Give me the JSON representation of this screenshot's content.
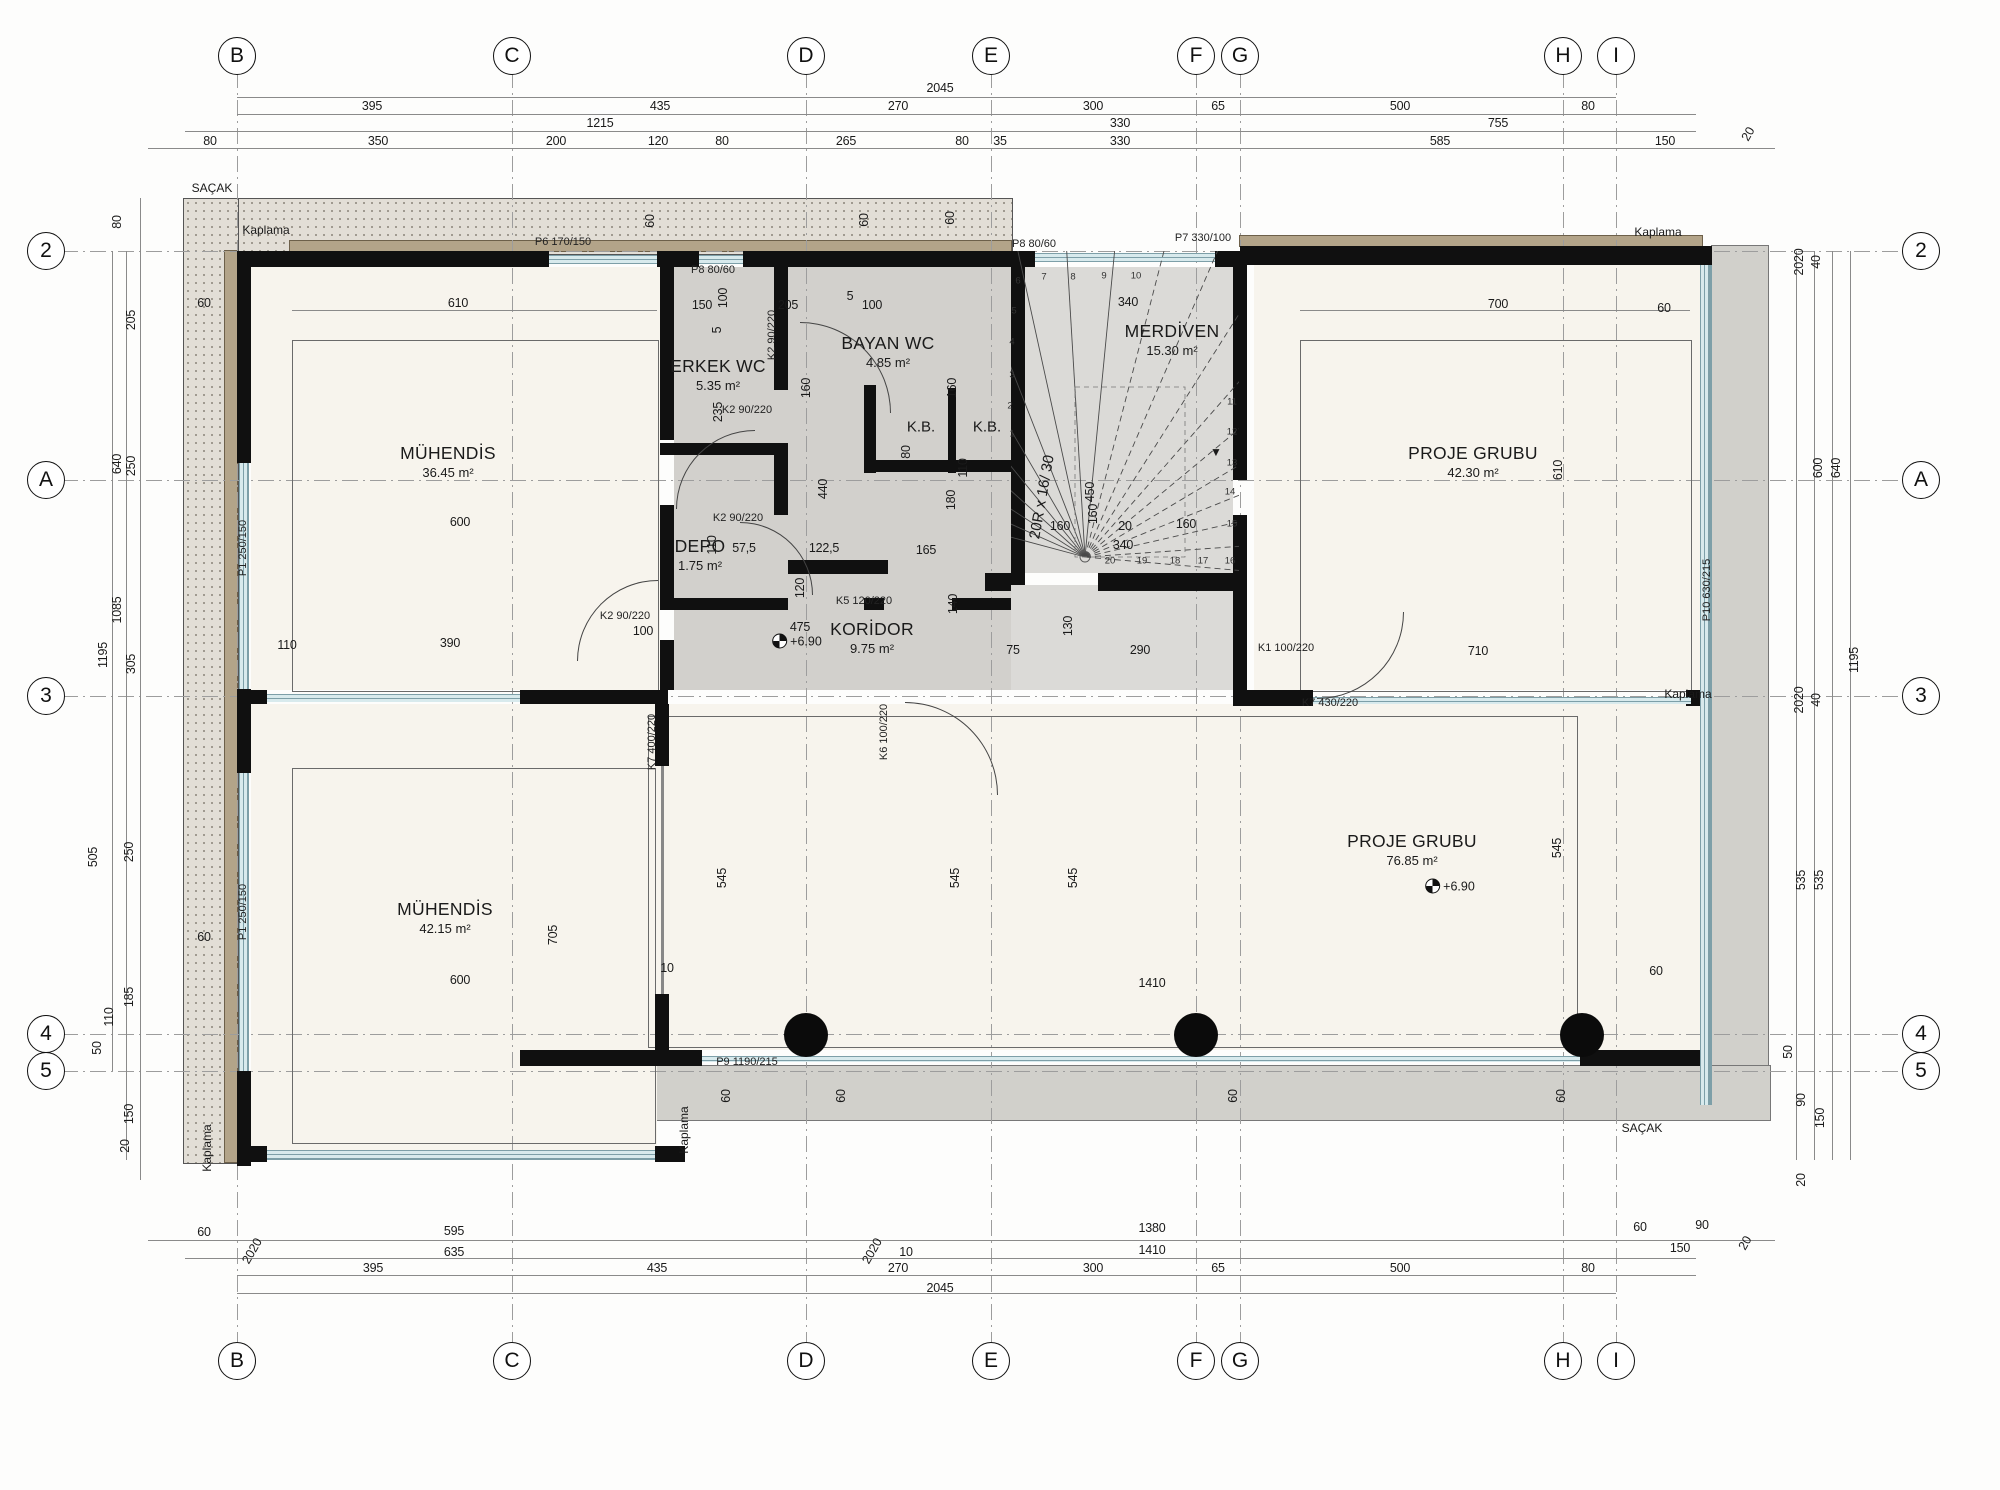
{
  "colors": {
    "wall": "#101010",
    "eave_fill": "#e2ded6",
    "eave_dot": "#9a948a",
    "kaplama_tan": "#b3a489",
    "service_floor": "#d2d0cc",
    "stair_floor": "#dbdad7",
    "room_floor": "#f7f4ed",
    "glazing": "#d8eaed",
    "glazing_frame": "#7d9fa8",
    "balcony": "#d1d0cb",
    "accent_ink": "#1a1a1a"
  },
  "grid": {
    "cols": [
      {
        "label": "B",
        "x": 237
      },
      {
        "label": "C",
        "x": 512
      },
      {
        "label": "D",
        "x": 806
      },
      {
        "label": "E",
        "x": 991
      },
      {
        "label": "F",
        "x": 1196
      },
      {
        "label": "G",
        "x": 1240
      },
      {
        "label": "H",
        "x": 1563
      },
      {
        "label": "I",
        "x": 1616
      }
    ],
    "rows": [
      {
        "label": "2",
        "y": 251
      },
      {
        "label": "A",
        "y": 480
      },
      {
        "label": "3",
        "y": 696
      },
      {
        "label": "4",
        "y": 1034
      },
      {
        "label": "5",
        "y": 1071
      }
    ]
  },
  "rooms": [
    {
      "name": "MÜHENDİS",
      "area": "36.45 m²",
      "x": 448,
      "y": 462
    },
    {
      "name": "ERKEK WC",
      "area": "5.35 m²",
      "x": 718,
      "y": 375
    },
    {
      "name": "BAYAN WC",
      "area": "4.85 m²",
      "x": 888,
      "y": 352
    },
    {
      "name": "DEPO",
      "area": "1.75 m²",
      "x": 700,
      "y": 555
    },
    {
      "name": "KORİDOR",
      "area": "9.75 m²",
      "x": 872,
      "y": 638
    },
    {
      "name": "MERDİVEN",
      "area": "15.30 m²",
      "x": 1172,
      "y": 340
    },
    {
      "name": "PROJE GRUBU",
      "area": "42.30 m²",
      "x": 1473,
      "y": 462
    },
    {
      "name": "MÜHENDİS",
      "area": "42.15 m²",
      "x": 445,
      "y": 918
    },
    {
      "name": "PROJE GRUBU",
      "area": "76.85 m²",
      "x": 1412,
      "y": 850
    }
  ],
  "kb": [
    {
      "label": "K.B.",
      "x": 921,
      "y": 427
    },
    {
      "label": "K.B.",
      "x": 987,
      "y": 427
    }
  ],
  "levels": [
    {
      "text": "+6.90",
      "x": 797,
      "y": 641
    },
    {
      "text": "+6.90",
      "x": 1450,
      "y": 886
    }
  ],
  "openings": [
    {
      "label": "P6 170/150",
      "x": 563,
      "y": 242
    },
    {
      "label": "P8 80/60",
      "x": 713,
      "y": 270
    },
    {
      "label": "P8 80/60",
      "x": 1034,
      "y": 244
    },
    {
      "label": "P7 330/100",
      "x": 1203,
      "y": 238
    },
    {
      "label": "P1 250/150",
      "x": 243,
      "y": 548,
      "r": -90
    },
    {
      "label": "P1 250/150",
      "x": 243,
      "y": 912,
      "r": -90
    },
    {
      "label": "K2 90/220",
      "x": 747,
      "y": 410
    },
    {
      "label": "K2 90/220",
      "x": 772,
      "y": 335,
      "r": -90
    },
    {
      "label": "K2 90/220",
      "x": 738,
      "y": 518
    },
    {
      "label": "K2 90/220",
      "x": 625,
      "y": 616
    },
    {
      "label": "K5 120/220",
      "x": 864,
      "y": 601
    },
    {
      "label": "K6 100/220",
      "x": 884,
      "y": 732,
      "r": -90
    },
    {
      "label": "K1 100/220",
      "x": 1286,
      "y": 648
    },
    {
      "label": "K7 430/220",
      "x": 1330,
      "y": 703
    },
    {
      "label": "K7 400/220",
      "x": 652,
      "y": 742,
      "r": -90
    },
    {
      "label": "P9 1190/215",
      "x": 747,
      "y": 1062
    },
    {
      "label": "P10 630/215",
      "x": 1707,
      "y": 590,
      "r": -90
    }
  ],
  "annotations": [
    {
      "text": "SAÇAK",
      "x": 212,
      "y": 188
    },
    {
      "text": "SAÇAK",
      "x": 1642,
      "y": 1128
    },
    {
      "text": "Kaplama",
      "x": 266,
      "y": 230
    },
    {
      "text": "Kaplama",
      "x": 1658,
      "y": 232
    },
    {
      "text": "Kaplama",
      "x": 1688,
      "y": 694
    },
    {
      "text": "Kaplama",
      "x": 684,
      "y": 1130,
      "r": -90
    },
    {
      "text": "Kaplama",
      "x": 207,
      "y": 1148,
      "r": -90
    },
    {
      "text": "▼",
      "x": 1216,
      "y": 452
    }
  ],
  "stair": {
    "note": "20R x 16/ 30",
    "note_x": 1042,
    "note_y": 497,
    "note_rot": -80,
    "cx": 1085,
    "cy": 557,
    "radius": 420,
    "angle_start": 165,
    "angle_end": -5,
    "count": 20,
    "treads": [
      {
        "n": "1",
        "x": 1012,
        "y": 434
      },
      {
        "n": "2",
        "x": 1010,
        "y": 406
      },
      {
        "n": "3",
        "x": 1012,
        "y": 375
      },
      {
        "n": "4",
        "x": 1012,
        "y": 342
      },
      {
        "n": "5",
        "x": 1014,
        "y": 311
      },
      {
        "n": "6",
        "x": 1018,
        "y": 281
      },
      {
        "n": "7",
        "x": 1044,
        "y": 277
      },
      {
        "n": "8",
        "x": 1073,
        "y": 277
      },
      {
        "n": "9",
        "x": 1104,
        "y": 276
      },
      {
        "n": "10",
        "x": 1136,
        "y": 276
      },
      {
        "n": "11",
        "x": 1232,
        "y": 402
      },
      {
        "n": "12",
        "x": 1232,
        "y": 432
      },
      {
        "n": "13",
        "x": 1232,
        "y": 463
      },
      {
        "n": "14",
        "x": 1230,
        "y": 492
      },
      {
        "n": "15",
        "x": 1232,
        "y": 524
      },
      {
        "n": "16",
        "x": 1230,
        "y": 561
      },
      {
        "n": "17",
        "x": 1203,
        "y": 561
      },
      {
        "n": "18",
        "x": 1175,
        "y": 561
      },
      {
        "n": "19",
        "x": 1142,
        "y": 561
      },
      {
        "n": "20",
        "x": 1110,
        "y": 561
      }
    ]
  },
  "dims": [
    {
      "t": "2045",
      "x": 940,
      "y": 88
    },
    {
      "t": "395",
      "x": 372,
      "y": 106
    },
    {
      "t": "435",
      "x": 660,
      "y": 106
    },
    {
      "t": "270",
      "x": 898,
      "y": 106
    },
    {
      "t": "300",
      "x": 1093,
      "y": 106
    },
    {
      "t": "65",
      "x": 1218,
      "y": 106
    },
    {
      "t": "500",
      "x": 1400,
      "y": 106
    },
    {
      "t": "80",
      "x": 1588,
      "y": 106
    },
    {
      "t": "1215",
      "x": 600,
      "y": 123
    },
    {
      "t": "330",
      "x": 1120,
      "y": 123
    },
    {
      "t": "755",
      "x": 1498,
      "y": 123
    },
    {
      "t": "80",
      "x": 210,
      "y": 141
    },
    {
      "t": "350",
      "x": 378,
      "y": 141
    },
    {
      "t": "200",
      "x": 556,
      "y": 141
    },
    {
      "t": "120",
      "x": 658,
      "y": 141
    },
    {
      "t": "80",
      "x": 722,
      "y": 141
    },
    {
      "t": "265",
      "x": 846,
      "y": 141
    },
    {
      "t": "80",
      "x": 962,
      "y": 141
    },
    {
      "t": "35",
      "x": 1000,
      "y": 141
    },
    {
      "t": "330",
      "x": 1120,
      "y": 141
    },
    {
      "t": "585",
      "x": 1440,
      "y": 141
    },
    {
      "t": "150",
      "x": 1665,
      "y": 141
    },
    {
      "t": "20",
      "x": 1748,
      "y": 134,
      "r": -60
    },
    {
      "t": "60",
      "x": 204,
      "y": 1232
    },
    {
      "t": "595",
      "x": 454,
      "y": 1231
    },
    {
      "t": "1380",
      "x": 1152,
      "y": 1228
    },
    {
      "t": "60",
      "x": 1640,
      "y": 1227
    },
    {
      "t": "90",
      "x": 1702,
      "y": 1225
    },
    {
      "t": "2020",
      "x": 252,
      "y": 1251,
      "r": -60
    },
    {
      "t": "635",
      "x": 454,
      "y": 1252
    },
    {
      "t": "2020",
      "x": 872,
      "y": 1251,
      "r": -60
    },
    {
      "t": "10",
      "x": 906,
      "y": 1252
    },
    {
      "t": "1410",
      "x": 1152,
      "y": 1250
    },
    {
      "t": "150",
      "x": 1680,
      "y": 1248
    },
    {
      "t": "20",
      "x": 1745,
      "y": 1243,
      "r": -60
    },
    {
      "t": "395",
      "x": 373,
      "y": 1268
    },
    {
      "t": "435",
      "x": 657,
      "y": 1268
    },
    {
      "t": "270",
      "x": 898,
      "y": 1268
    },
    {
      "t": "300",
      "x": 1093,
      "y": 1268
    },
    {
      "t": "65",
      "x": 1218,
      "y": 1268
    },
    {
      "t": "500",
      "x": 1400,
      "y": 1268
    },
    {
      "t": "80",
      "x": 1588,
      "y": 1268
    },
    {
      "t": "2045",
      "x": 940,
      "y": 1288
    },
    {
      "t": "80",
      "x": 117,
      "y": 222,
      "r": -90
    },
    {
      "t": "205",
      "x": 131,
      "y": 320,
      "r": -90
    },
    {
      "t": "250",
      "x": 131,
      "y": 466,
      "r": -90
    },
    {
      "t": "640",
      "x": 117,
      "y": 464,
      "r": -90
    },
    {
      "t": "1085",
      "x": 117,
      "y": 610,
      "r": -90
    },
    {
      "t": "1195",
      "x": 103,
      "y": 655,
      "r": -90
    },
    {
      "t": "305",
      "x": 131,
      "y": 664,
      "r": -90
    },
    {
      "t": "250",
      "x": 129,
      "y": 852,
      "r": -90
    },
    {
      "t": "505",
      "x": 93,
      "y": 857,
      "r": -90
    },
    {
      "t": "185",
      "x": 129,
      "y": 997,
      "r": -90
    },
    {
      "t": "110",
      "x": 109,
      "y": 1017,
      "r": -90
    },
    {
      "t": "50",
      "x": 97,
      "y": 1048,
      "r": -90
    },
    {
      "t": "150",
      "x": 129,
      "y": 1114,
      "r": -90
    },
    {
      "t": "20",
      "x": 125,
      "y": 1146,
      "r": -90
    },
    {
      "t": "2020",
      "x": 1799,
      "y": 262,
      "r": -90
    },
    {
      "t": "40",
      "x": 1816,
      "y": 262,
      "r": -90
    },
    {
      "t": "600",
      "x": 1818,
      "y": 468,
      "r": -90
    },
    {
      "t": "640",
      "x": 1836,
      "y": 468,
      "r": -90
    },
    {
      "t": "1195",
      "x": 1854,
      "y": 660,
      "r": -90
    },
    {
      "t": "2020",
      "x": 1799,
      "y": 700,
      "r": -90
    },
    {
      "t": "40",
      "x": 1816,
      "y": 700,
      "r": -90
    },
    {
      "t": "535",
      "x": 1801,
      "y": 880,
      "r": -90
    },
    {
      "t": "535",
      "x": 1819,
      "y": 880,
      "r": -90
    },
    {
      "t": "90",
      "x": 1801,
      "y": 1100,
      "r": -90
    },
    {
      "t": "150",
      "x": 1820,
      "y": 1118,
      "r": -90
    },
    {
      "t": "20",
      "x": 1801,
      "y": 1180,
      "r": -90
    },
    {
      "t": "50",
      "x": 1788,
      "y": 1052,
      "r": -90
    },
    {
      "t": "610",
      "x": 458,
      "y": 303
    },
    {
      "t": "60",
      "x": 204,
      "y": 303
    },
    {
      "t": "600",
      "x": 460,
      "y": 522
    },
    {
      "t": "110",
      "x": 287,
      "y": 645
    },
    {
      "t": "390",
      "x": 450,
      "y": 643
    },
    {
      "t": "60",
      "x": 204,
      "y": 937
    },
    {
      "t": "705",
      "x": 553,
      "y": 935,
      "r": -90
    },
    {
      "t": "600",
      "x": 460,
      "y": 980
    },
    {
      "t": "10",
      "x": 667,
      "y": 968
    },
    {
      "t": "150",
      "x": 702,
      "y": 305
    },
    {
      "t": "100",
      "x": 723,
      "y": 298,
      "r": -90
    },
    {
      "t": "5",
      "x": 717,
      "y": 330,
      "r": -90
    },
    {
      "t": "235",
      "x": 718,
      "y": 412,
      "r": -90
    },
    {
      "t": "205",
      "x": 788,
      "y": 305
    },
    {
      "t": "5",
      "x": 850,
      "y": 296
    },
    {
      "t": "100",
      "x": 872,
      "y": 305
    },
    {
      "t": "160",
      "x": 806,
      "y": 388,
      "r": -90
    },
    {
      "t": "160",
      "x": 952,
      "y": 388,
      "r": -90
    },
    {
      "t": "110",
      "x": 963,
      "y": 468,
      "r": -90
    },
    {
      "t": "80",
      "x": 906,
      "y": 452,
      "r": -90
    },
    {
      "t": "440",
      "x": 823,
      "y": 489,
      "r": -90
    },
    {
      "t": "57,5",
      "x": 744,
      "y": 548
    },
    {
      "t": "122,5",
      "x": 824,
      "y": 548
    },
    {
      "t": "110",
      "x": 712,
      "y": 545,
      "r": -90
    },
    {
      "t": "165",
      "x": 926,
      "y": 550
    },
    {
      "t": "180",
      "x": 951,
      "y": 500,
      "r": -90
    },
    {
      "t": "140",
      "x": 953,
      "y": 604,
      "r": -90
    },
    {
      "t": "120",
      "x": 800,
      "y": 588,
      "r": -90
    },
    {
      "t": "475",
      "x": 800,
      "y": 627
    },
    {
      "t": "100",
      "x": 643,
      "y": 631
    },
    {
      "t": "340",
      "x": 1128,
      "y": 302
    },
    {
      "t": "450",
      "x": 1090,
      "y": 492,
      "r": -90
    },
    {
      "t": "160",
      "x": 1060,
      "y": 526
    },
    {
      "t": "160",
      "x": 1093,
      "y": 514,
      "r": -90
    },
    {
      "t": "20",
      "x": 1125,
      "y": 526
    },
    {
      "t": "160",
      "x": 1186,
      "y": 524
    },
    {
      "t": "340",
      "x": 1123,
      "y": 545
    },
    {
      "t": "130",
      "x": 1068,
      "y": 626,
      "r": -90
    },
    {
      "t": "75",
      "x": 1013,
      "y": 650
    },
    {
      "t": "290",
      "x": 1140,
      "y": 650
    },
    {
      "t": "710",
      "x": 1478,
      "y": 651
    },
    {
      "t": "700",
      "x": 1498,
      "y": 304
    },
    {
      "t": "610",
      "x": 1558,
      "y": 470,
      "r": -90
    },
    {
      "t": "545",
      "x": 722,
      "y": 878,
      "r": -90
    },
    {
      "t": "545",
      "x": 955,
      "y": 878,
      "r": -90
    },
    {
      "t": "545",
      "x": 1073,
      "y": 878,
      "r": -90
    },
    {
      "t": "545",
      "x": 1557,
      "y": 848,
      "r": -90
    },
    {
      "t": "1410",
      "x": 1152,
      "y": 983
    },
    {
      "t": "60",
      "x": 1656,
      "y": 971
    },
    {
      "t": "60",
      "x": 1664,
      "y": 308
    },
    {
      "t": "60",
      "x": 726,
      "y": 1096,
      "r": -90
    },
    {
      "t": "60",
      "x": 841,
      "y": 1096,
      "r": -90
    },
    {
      "t": "60",
      "x": 1233,
      "y": 1096,
      "r": -90
    },
    {
      "t": "60",
      "x": 1561,
      "y": 1096,
      "r": -90
    },
    {
      "t": "60",
      "x": 650,
      "y": 221,
      "r": -90
    },
    {
      "t": "60",
      "x": 864,
      "y": 220,
      "r": -90
    },
    {
      "t": "60",
      "x": 950,
      "y": 218,
      "r": -90
    }
  ]
}
